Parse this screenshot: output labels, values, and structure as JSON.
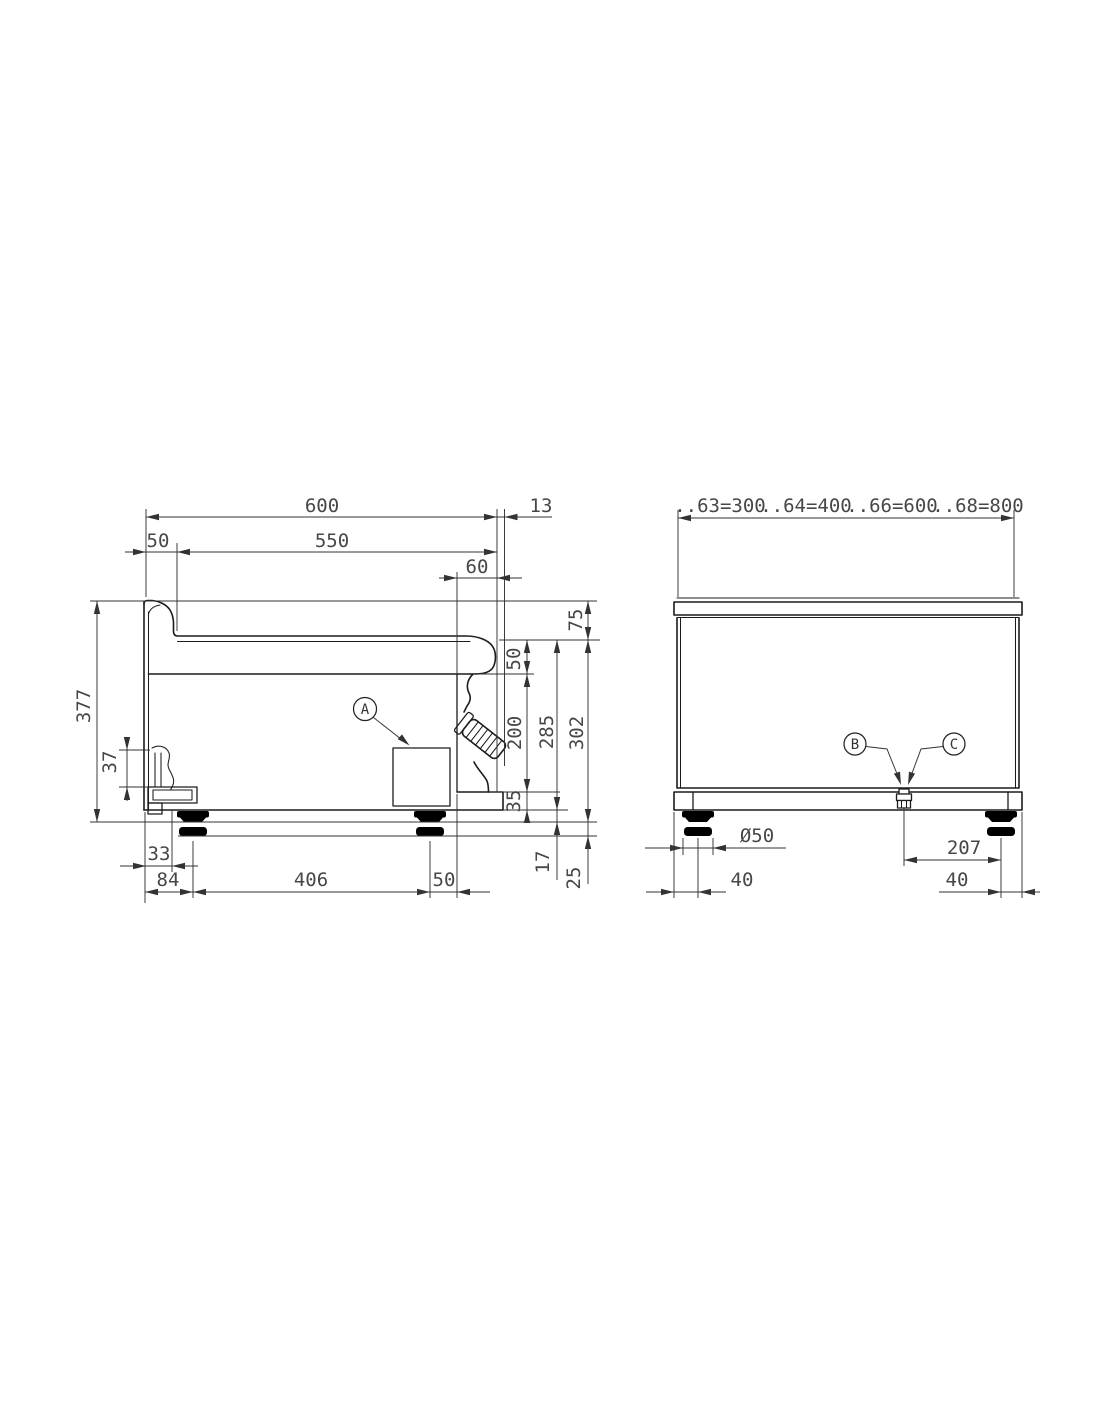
{
  "drawing": {
    "background": "#ffffff",
    "line_color": "#1c1c1c",
    "dim_color": "#333333",
    "text_color": "#474747",
    "side_view": {
      "dims": {
        "depth_total": "600",
        "front_offset": "13",
        "back_inset": "50",
        "surface_depth": "550",
        "control_inset": "60",
        "splash_height": "75",
        "plate_drop": "50",
        "panel_height": "200",
        "recess_height": "35",
        "height_to_base": "285",
        "height_to_floor": "302",
        "height_total": "377",
        "fitting_height": "37",
        "fitting_offset": "33",
        "rear_foot_offset": "84",
        "foot_spacing": "406",
        "front_foot_offset": "50",
        "foot_min_height": "17",
        "foot_adjustment": "25"
      },
      "callout_a": "A"
    },
    "front_view": {
      "width_variants": [
        "..63=300",
        "..64=400",
        "..66=600",
        "..68=800"
      ],
      "dims": {
        "foot_diameter": "Ø50",
        "connection_to_foot": "207",
        "left_foot_inset": "40",
        "right_foot_inset": "40"
      },
      "callout_b": "B",
      "callout_c": "C"
    }
  }
}
